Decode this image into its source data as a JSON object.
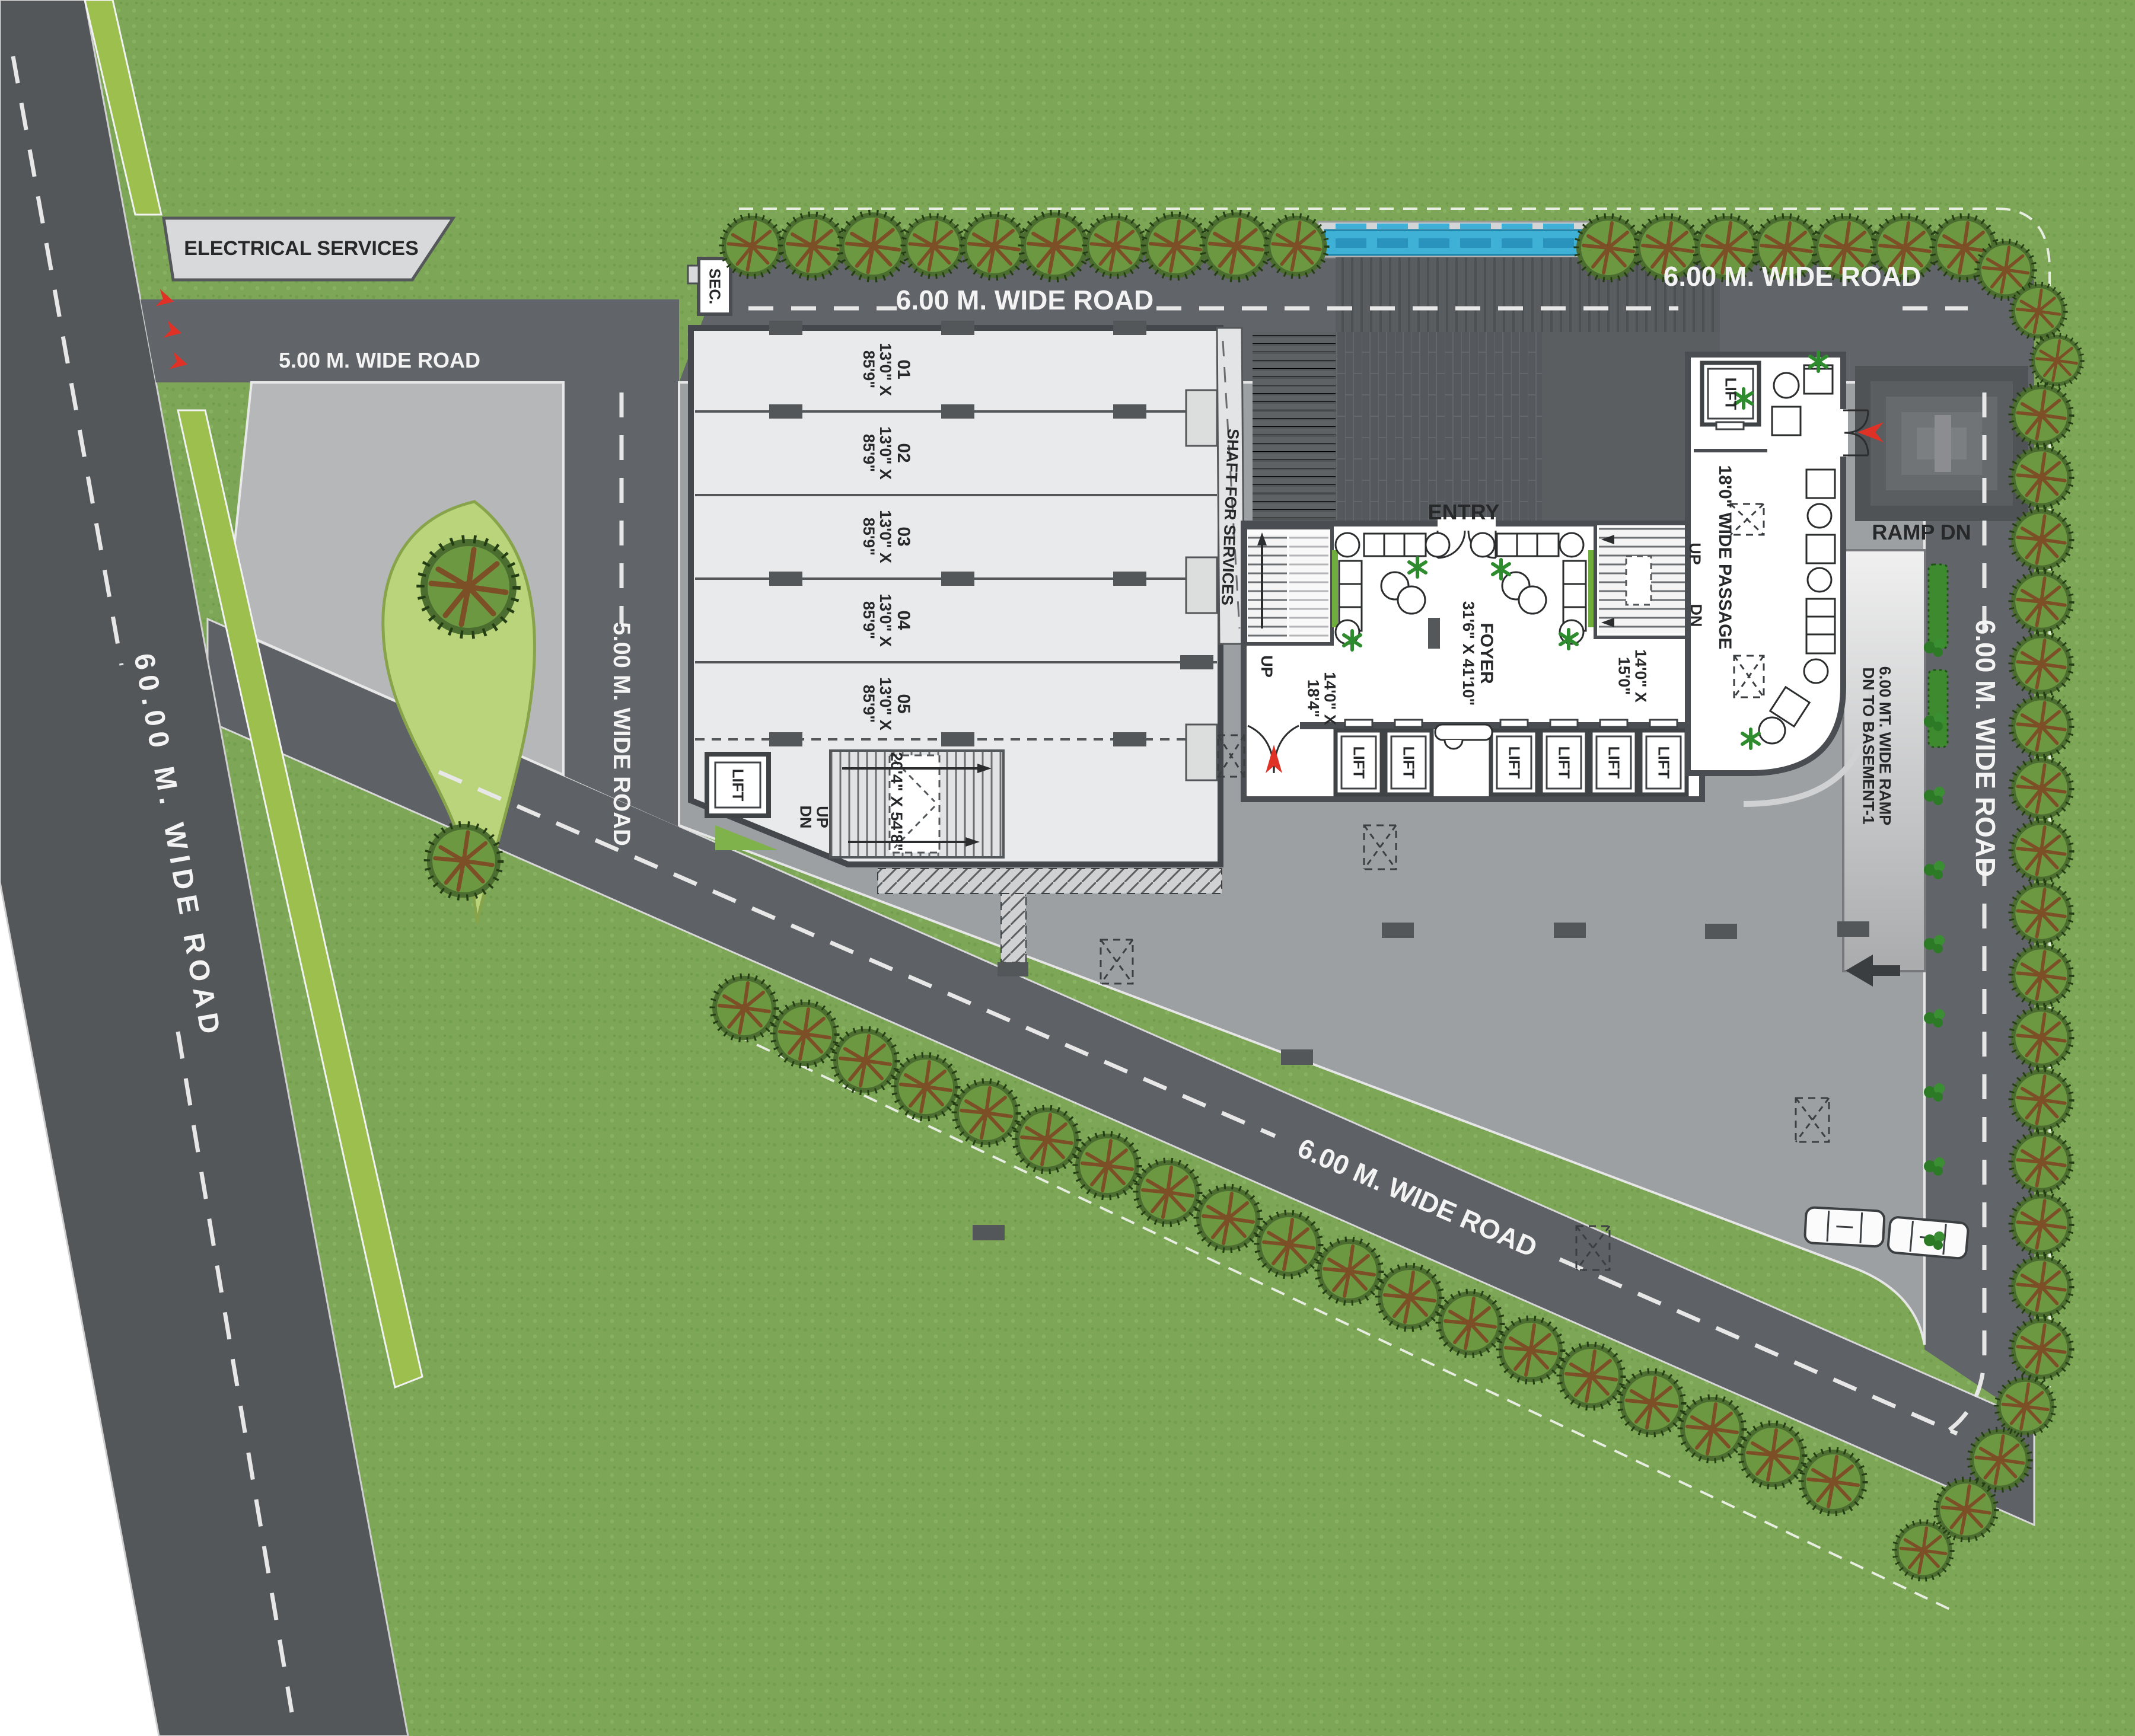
{
  "plan": {
    "roads": {
      "road_60m": "60.00 M. WIDE ROAD",
      "road_5m": "5.00 M. WIDE ROAD",
      "road_6m": "6.00 M. WIDE ROAD"
    },
    "areas": {
      "electrical_services": "ELECTRICAL SERVICES",
      "security_cabin": "SEC.",
      "shaft": "SHAFT FOR SERVICES",
      "entry": "ENTRY",
      "foyer_name": "FOYER",
      "foyer_size": "31'6\" X 41'10\"",
      "stair_lobby_left_l1": "14'0\" X",
      "stair_lobby_left_l2": "18'4\"",
      "stair_lobby_right_l1": "14'0\" X",
      "stair_lobby_right_l2": "15'0\"",
      "hall_size": "20'4\" X 54'8\"",
      "passage": "18'0\" WIDE PASSAGE",
      "ramp_dn": "RAMP DN",
      "ramp_l1": "6.00 MT. WIDE RAMP",
      "ramp_l2": "DN TO BASEMENT-1",
      "lift": "LIFT",
      "up": "UP",
      "dn": "DN"
    },
    "units": [
      {
        "no": "01",
        "d1": "13'0\" X",
        "d2": "85'9\""
      },
      {
        "no": "02",
        "d1": "13'0\" X",
        "d2": "85'9\""
      },
      {
        "no": "03",
        "d1": "13'0\" X",
        "d2": "85'9\""
      },
      {
        "no": "04",
        "d1": "13'0\" X",
        "d2": "85'9\""
      },
      {
        "no": "05",
        "d1": "13'0\" X",
        "d2": "85'9\""
      }
    ],
    "colors": {
      "grass": "#7da757",
      "road": "#5d6064",
      "paving": "#b5b7b9",
      "parking": "#9da0a3",
      "building": "#e9eaeb",
      "water": "#3fb0d6",
      "accent_red": "#e03127",
      "plant": "#6fae3c"
    }
  }
}
